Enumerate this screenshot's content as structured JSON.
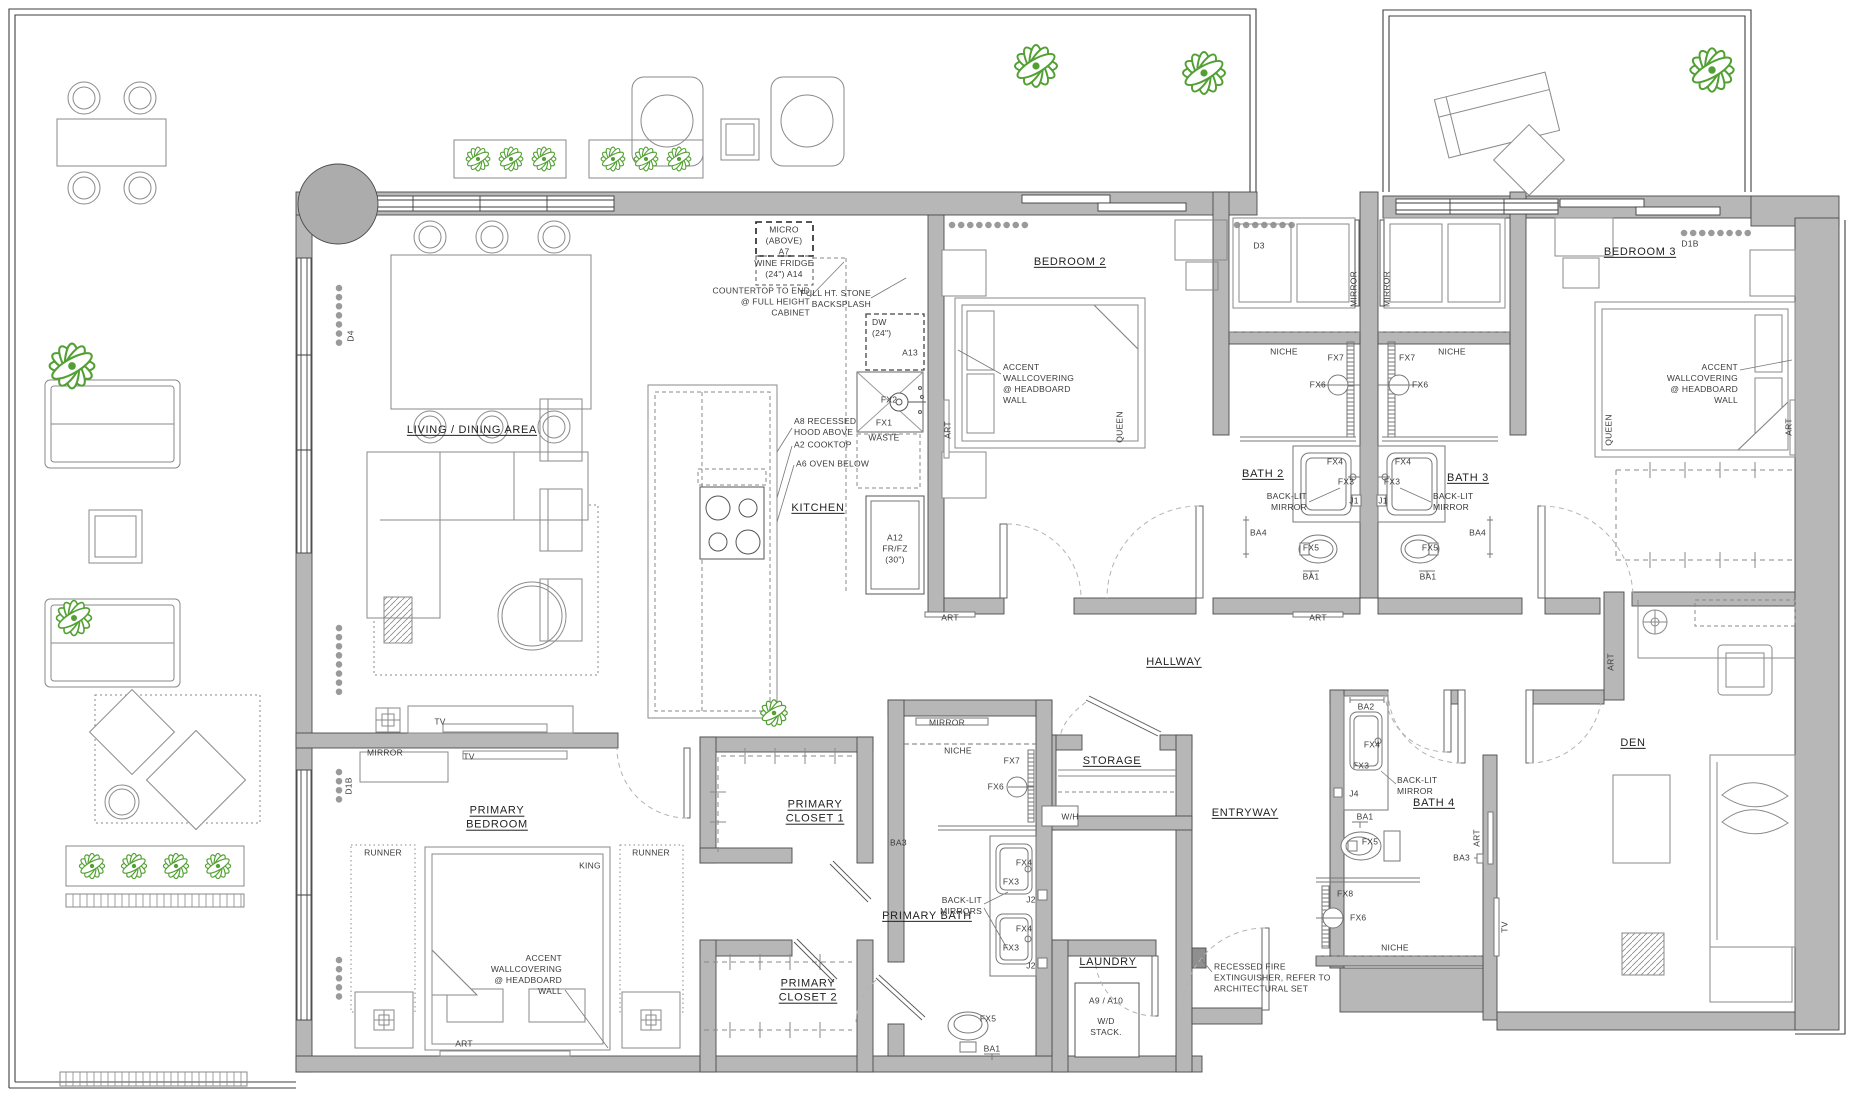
{
  "colors": {
    "wall_fill": "#b7b7b7",
    "line_dark": "#4b4b4b",
    "furniture_line": "#8a8a8a",
    "plant_green": "#52a033",
    "label_text": "#2d2d2d"
  },
  "plan": {
    "rooms": [
      {
        "text": "LIVING / DINING AREA",
        "x": 472,
        "y": 430
      },
      {
        "text": "KITCHEN",
        "x": 818,
        "y": 508
      },
      {
        "text": "BEDROOM 2",
        "x": 1070,
        "y": 262
      },
      {
        "text": "BEDROOM 3",
        "x": 1640,
        "y": 252
      },
      {
        "text": "BATH 2",
        "x": 1263,
        "y": 474
      },
      {
        "text": "BATH 3",
        "x": 1468,
        "y": 478
      },
      {
        "text": "HALLWAY",
        "x": 1174,
        "y": 662
      },
      {
        "text": "STORAGE",
        "x": 1112,
        "y": 761
      },
      {
        "text": "ENTRYWAY",
        "x": 1245,
        "y": 813
      },
      {
        "text": "BATH 4",
        "x": 1434,
        "y": 803
      },
      {
        "text": "DEN",
        "x": 1633,
        "y": 743
      },
      {
        "text": "LAUNDRY",
        "x": 1108,
        "y": 962
      },
      {
        "text": "PRIMARY BATH",
        "x": 927,
        "y": 916
      },
      {
        "text": "PRIMARY\nBEDROOM",
        "x": 497,
        "y": 818
      },
      {
        "text": "PRIMARY\nCLOSET 1",
        "x": 815,
        "y": 812
      },
      {
        "text": "PRIMARY\nCLOSET 2",
        "x": 808,
        "y": 991
      }
    ],
    "annotations": [
      {
        "text": "MICRO\n(ABOVE)\nA7",
        "x": 784,
        "y": 241
      },
      {
        "text": "WINE FRIDGE\n(24\")  A14",
        "x": 784,
        "y": 269
      },
      {
        "text": "COUNTERTOP TO END\n@ FULL HEIGHT\nCABINET",
        "x": 810,
        "y": 302,
        "a": "r"
      },
      {
        "text": "FULL HT. STONE\nBACKSPLASH",
        "x": 871,
        "y": 299,
        "a": "r"
      },
      {
        "text": "DW\n(24\")",
        "x": 872,
        "y": 328,
        "a": "l"
      },
      {
        "text": "A13",
        "x": 910,
        "y": 353
      },
      {
        "text": "FX2",
        "x": 889,
        "y": 400
      },
      {
        "text": "FX1",
        "x": 884,
        "y": 423
      },
      {
        "text": "WASTE",
        "x": 884,
        "y": 438
      },
      {
        "text": "A8 RECESSED\nHOOD ABOVE",
        "x": 794,
        "y": 427,
        "a": "l"
      },
      {
        "text": "A2 COOKTOP",
        "x": 794,
        "y": 445,
        "a": "l"
      },
      {
        "text": "A6 OVEN BELOW",
        "x": 796,
        "y": 464,
        "a": "l"
      },
      {
        "text": "A12\nFR/FZ\n(30\")",
        "x": 895,
        "y": 549
      },
      {
        "text": "ACCENT\nWALLCOVERING\n@ HEADBOARD\nWALL",
        "x": 1003,
        "y": 384,
        "a": "l"
      },
      {
        "text": "QUEEN",
        "x": 1120,
        "y": 427,
        "r": -90
      },
      {
        "text": "ART",
        "x": 948,
        "y": 430,
        "r": -90
      },
      {
        "text": "MIRROR",
        "x": 1354,
        "y": 289,
        "r": -90
      },
      {
        "text": "MIRROR",
        "x": 1387,
        "y": 289,
        "r": -90
      },
      {
        "text": "D3",
        "x": 1259,
        "y": 246
      },
      {
        "text": "NICHE",
        "x": 1284,
        "y": 352
      },
      {
        "text": "NICHE",
        "x": 1452,
        "y": 352
      },
      {
        "text": "FX7",
        "x": 1344,
        "y": 358,
        "a": "r"
      },
      {
        "text": "FX7",
        "x": 1399,
        "y": 358,
        "a": "l"
      },
      {
        "text": "FX6",
        "x": 1326,
        "y": 385,
        "a": "r"
      },
      {
        "text": "FX6",
        "x": 1412,
        "y": 385,
        "a": "l"
      },
      {
        "text": "FX4",
        "x": 1335,
        "y": 462
      },
      {
        "text": "FX4",
        "x": 1403,
        "y": 462
      },
      {
        "text": "FX3",
        "x": 1346,
        "y": 482
      },
      {
        "text": "FX3",
        "x": 1392,
        "y": 482
      },
      {
        "text": "J1",
        "x": 1354,
        "y": 501
      },
      {
        "text": "J1",
        "x": 1383,
        "y": 501
      },
      {
        "text": "BACK-LIT\nMIRROR",
        "x": 1307,
        "y": 502,
        "a": "r"
      },
      {
        "text": "BACK-LIT\nMIRROR",
        "x": 1433,
        "y": 502,
        "a": "l"
      },
      {
        "text": "FX5",
        "x": 1311,
        "y": 548
      },
      {
        "text": "FX5",
        "x": 1430,
        "y": 548
      },
      {
        "text": "BA1",
        "x": 1311,
        "y": 577
      },
      {
        "text": "BA1",
        "x": 1428,
        "y": 577
      },
      {
        "text": "BA4",
        "x": 1250,
        "y": 533,
        "a": "l"
      },
      {
        "text": "BA4",
        "x": 1486,
        "y": 533,
        "a": "r"
      },
      {
        "text": "ART",
        "x": 950,
        "y": 618
      },
      {
        "text": "ART",
        "x": 1318,
        "y": 618
      },
      {
        "text": "D1B",
        "x": 1690,
        "y": 244
      },
      {
        "text": "ACCENT\nWALLCOVERING\n@ HEADBOARD\nWALL",
        "x": 1738,
        "y": 384,
        "a": "r"
      },
      {
        "text": "QUEEN",
        "x": 1609,
        "y": 430,
        "r": -90
      },
      {
        "text": "ART",
        "x": 1789,
        "y": 427,
        "r": -90
      },
      {
        "text": "RUNNER",
        "x": 383,
        "y": 853
      },
      {
        "text": "RUNNER",
        "x": 651,
        "y": 853
      },
      {
        "text": "KING",
        "x": 590,
        "y": 866
      },
      {
        "text": "ACCENT\nWALLCOVERING\n@ HEADBOARD\nWALL",
        "x": 562,
        "y": 975,
        "a": "r"
      },
      {
        "text": "ART",
        "x": 464,
        "y": 1044
      },
      {
        "text": "MIRROR",
        "x": 385,
        "y": 753
      },
      {
        "text": "TV",
        "x": 440,
        "y": 722
      },
      {
        "text": "TV",
        "x": 469,
        "y": 757
      },
      {
        "text": "D1B",
        "x": 349,
        "y": 786,
        "r": -90
      },
      {
        "text": "D4",
        "x": 351,
        "y": 336,
        "r": -90
      },
      {
        "text": "BA3",
        "x": 890,
        "y": 843,
        "a": "l"
      },
      {
        "text": "MIRROR",
        "x": 947,
        "y": 723
      },
      {
        "text": "NICHE",
        "x": 958,
        "y": 751
      },
      {
        "text": "FX7",
        "x": 1020,
        "y": 761,
        "a": "r"
      },
      {
        "text": "FX6",
        "x": 1004,
        "y": 787,
        "a": "r"
      },
      {
        "text": "W/H",
        "x": 1070,
        "y": 817
      },
      {
        "text": "FX4",
        "x": 1024,
        "y": 863
      },
      {
        "text": "FX3",
        "x": 1011,
        "y": 882
      },
      {
        "text": "J2",
        "x": 1031,
        "y": 900
      },
      {
        "text": "FX4",
        "x": 1024,
        "y": 929
      },
      {
        "text": "FX3",
        "x": 1011,
        "y": 948
      },
      {
        "text": "J2",
        "x": 1031,
        "y": 966
      },
      {
        "text": "BACK-LIT\nMIRRORS",
        "x": 982,
        "y": 906,
        "a": "r"
      },
      {
        "text": "FX5",
        "x": 988,
        "y": 1019
      },
      {
        "text": "BA1",
        "x": 992,
        "y": 1049
      },
      {
        "text": "A9 / A10",
        "x": 1106,
        "y": 1001
      },
      {
        "text": "W/D\nSTACK.",
        "x": 1106,
        "y": 1027
      },
      {
        "text": "RECESSED FIRE\nEXTINGUISHER, REFER TO\nARCHITECTURAL SET",
        "x": 1214,
        "y": 978,
        "a": "l"
      },
      {
        "text": "BA2",
        "x": 1366,
        "y": 707
      },
      {
        "text": "FX4",
        "x": 1372,
        "y": 745
      },
      {
        "text": "FX3",
        "x": 1361,
        "y": 766
      },
      {
        "text": "BACK-LIT\nMIRROR",
        "x": 1397,
        "y": 786,
        "a": "l"
      },
      {
        "text": "J4",
        "x": 1354,
        "y": 794
      },
      {
        "text": "BA1",
        "x": 1365,
        "y": 817
      },
      {
        "text": "FX5",
        "x": 1370,
        "y": 842
      },
      {
        "text": "ART",
        "x": 1477,
        "y": 838,
        "r": -90
      },
      {
        "text": "BA3",
        "x": 1470,
        "y": 858,
        "a": "r"
      },
      {
        "text": "FX8",
        "x": 1337,
        "y": 894,
        "a": "l"
      },
      {
        "text": "FX6",
        "x": 1350,
        "y": 918,
        "a": "l"
      },
      {
        "text": "NICHE",
        "x": 1395,
        "y": 948
      },
      {
        "text": "TV",
        "x": 1505,
        "y": 927,
        "r": -90
      },
      {
        "text": "ART",
        "x": 1611,
        "y": 662,
        "r": -90
      }
    ]
  }
}
